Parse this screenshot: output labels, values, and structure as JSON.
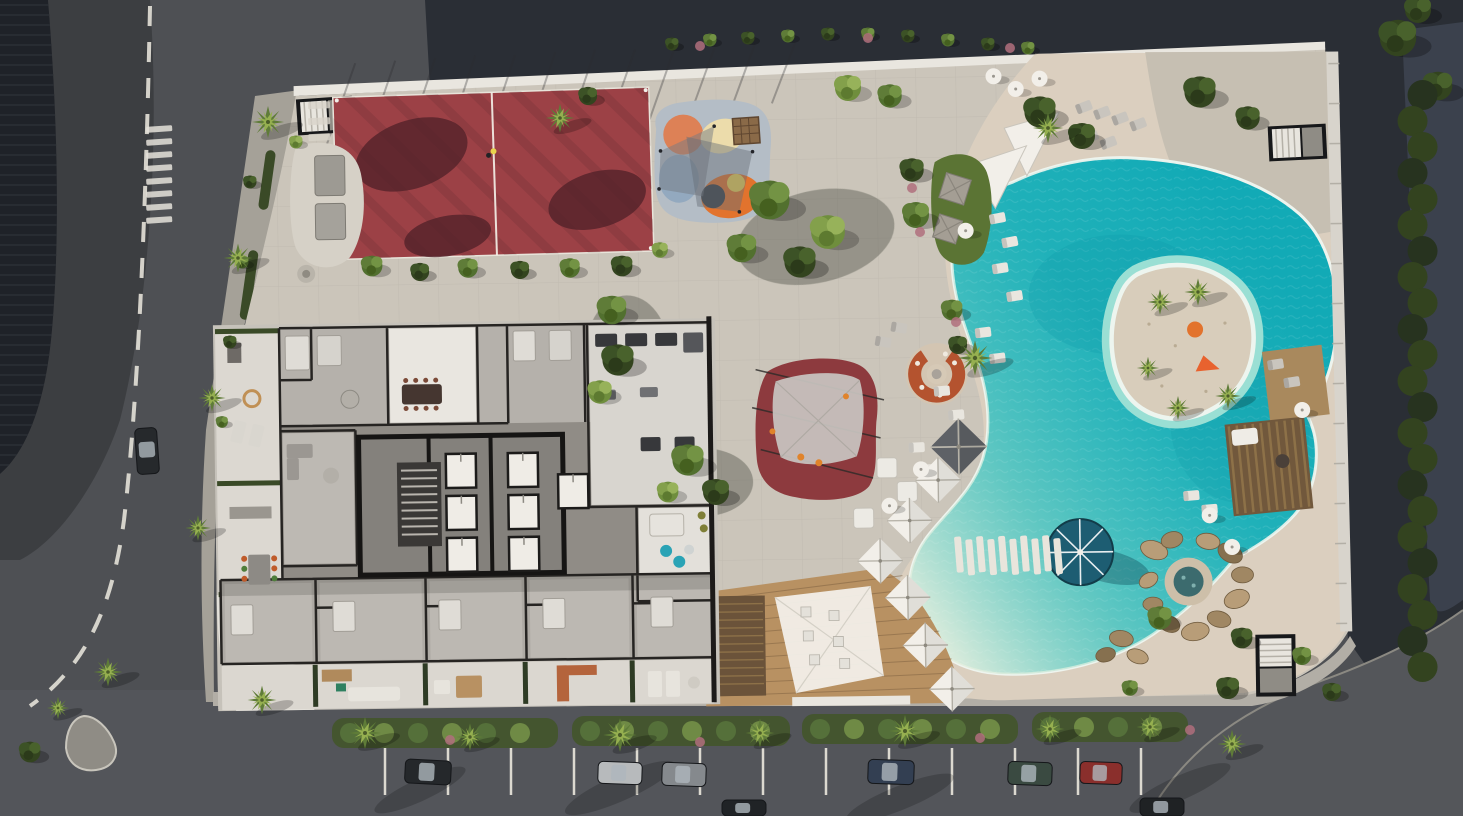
{
  "scene": {
    "type": "aerial-architectural-render",
    "description": "Aerial 3D rendering of a residential resort block: cutaway apartment floor plan, red sports court, playgrounds, gardens, lagoon-style pool with island, beach club deck, surrounding streets with parked cars and palm trees.",
    "areas": {
      "street_left": {
        "label": "Street with dashed lane line"
      },
      "street_bottom": {
        "label": "Street with parallel parking"
      },
      "roof_corner": {
        "label": "Adjacent building roof"
      },
      "site": {
        "label": "Resort podium deck"
      },
      "court": {
        "label": "Red multi-sport court"
      },
      "playground": {
        "label": "Colorful kids playground"
      },
      "canopy_playground": {
        "label": "Red play area with shade sail"
      },
      "firepit": {
        "label": "Sunken fire-pit lounge"
      },
      "gardens": {
        "label": "Landscaped garden paths"
      },
      "pool": {
        "label": "Lagoon swimming pool"
      },
      "island": {
        "label": "Pool island with palms"
      },
      "spa": {
        "label": "Rock grotto spa"
      },
      "deck": {
        "label": "Beach-club timber deck"
      },
      "building": {
        "label": "Apartment building floor plan"
      },
      "parking": {
        "label": "Street parking with cars"
      },
      "hedge_right": {
        "label": "Perimeter hedge"
      }
    },
    "palms": [
      [
        268,
        122,
        1.0
      ],
      [
        238,
        258,
        0.9
      ],
      [
        212,
        398,
        0.85
      ],
      [
        198,
        528,
        0.8
      ],
      [
        108,
        672,
        0.9
      ],
      [
        58,
        708,
        0.7
      ],
      [
        262,
        700,
        0.9
      ],
      [
        365,
        733,
        1.0
      ],
      [
        470,
        737,
        0.85
      ],
      [
        620,
        735,
        1.05
      ],
      [
        760,
        733,
        0.9
      ],
      [
        905,
        731,
        1.0
      ],
      [
        1050,
        729,
        0.9
      ],
      [
        1150,
        727,
        0.85
      ],
      [
        1232,
        744,
        0.9
      ],
      [
        975,
        358,
        1.1
      ],
      [
        1048,
        128,
        0.95
      ],
      [
        560,
        118,
        0.9
      ],
      [
        1160,
        302,
        0.8
      ],
      [
        1198,
        292,
        0.85
      ],
      [
        1228,
        396,
        0.8
      ],
      [
        1178,
        408,
        0.75
      ],
      [
        1148,
        368,
        0.7
      ]
    ],
    "trees": [
      [
        "m",
        770,
        200,
        1.5
      ],
      [
        "l",
        828,
        232,
        1.3
      ],
      [
        "d",
        800,
        262,
        1.2
      ],
      [
        "m",
        742,
        248,
        1.1
      ],
      [
        "m",
        612,
        310,
        1.1
      ],
      [
        "d",
        618,
        360,
        1.2
      ],
      [
        "l",
        600,
        392,
        0.9
      ],
      [
        "m",
        688,
        460,
        1.2
      ],
      [
        "d",
        716,
        492,
        1.0
      ],
      [
        "l",
        668,
        492,
        0.8
      ],
      [
        "d",
        912,
        170,
        0.9
      ],
      [
        "m",
        916,
        215,
        1.0
      ],
      [
        "m",
        952,
        310,
        0.8
      ],
      [
        "d",
        958,
        345,
        0.7
      ],
      [
        "l",
        848,
        88,
        1.0
      ],
      [
        "m",
        890,
        96,
        0.9
      ],
      [
        "d",
        1040,
        112,
        1.2
      ],
      [
        "d",
        1082,
        136,
        1.0
      ],
      [
        "d",
        1200,
        92,
        1.2
      ],
      [
        "d",
        1248,
        118,
        0.9
      ],
      [
        "d",
        1398,
        38,
        1.4
      ],
      [
        "d",
        1438,
        86,
        1.1
      ],
      [
        "d",
        1418,
        10,
        1.0
      ],
      [
        "m",
        1160,
        618,
        0.9
      ],
      [
        "d",
        1242,
        638,
        0.8
      ],
      [
        "m",
        1302,
        656,
        0.7
      ],
      [
        "d",
        1228,
        688,
        0.85
      ],
      [
        "m",
        1130,
        688,
        0.6
      ],
      [
        "d",
        1332,
        692,
        0.7
      ],
      [
        "m",
        372,
        266,
        0.8
      ],
      [
        "d",
        420,
        272,
        0.7
      ],
      [
        "m",
        468,
        268,
        0.75
      ],
      [
        "d",
        520,
        270,
        0.7
      ],
      [
        "m",
        570,
        268,
        0.75
      ],
      [
        "d",
        622,
        266,
        0.8
      ],
      [
        "l",
        660,
        250,
        0.6
      ],
      [
        "d",
        250,
        182,
        0.5
      ],
      [
        "m",
        242,
        262,
        0.5
      ],
      [
        "d",
        230,
        342,
        0.5
      ],
      [
        "m",
        222,
        422,
        0.45
      ],
      [
        "d",
        588,
        96,
        0.7
      ],
      [
        "l",
        296,
        142,
        0.5
      ],
      [
        "d",
        30,
        752,
        0.8
      ],
      [
        "d",
        672,
        44,
        0.5
      ],
      [
        "m",
        710,
        40,
        0.5
      ],
      [
        "d",
        748,
        38,
        0.5
      ],
      [
        "m",
        788,
        36,
        0.5
      ],
      [
        "d",
        828,
        34,
        0.5
      ],
      [
        "m",
        868,
        34,
        0.5
      ],
      [
        "d",
        908,
        36,
        0.5
      ],
      [
        "m",
        948,
        40,
        0.5
      ],
      [
        "d",
        988,
        44,
        0.5
      ],
      [
        "m",
        1028,
        48,
        0.5
      ]
    ],
    "pink_bushes": [
      [
        912,
        188
      ],
      [
        920,
        232
      ],
      [
        956,
        322
      ],
      [
        700,
        46
      ],
      [
        868,
        38
      ],
      [
        1010,
        48
      ],
      [
        450,
        740
      ],
      [
        700,
        742
      ],
      [
        980,
        738
      ],
      [
        1190,
        730
      ]
    ],
    "loungers": [
      [
        1000,
        222,
        -10,
        "w"
      ],
      [
        1012,
        246,
        -10,
        "w"
      ],
      [
        1002,
        272,
        -8,
        "w"
      ],
      [
        1016,
        300,
        -8,
        "w"
      ],
      [
        984,
        336,
        -6,
        "w"
      ],
      [
        998,
        362,
        -6,
        "w"
      ],
      [
        942,
        394,
        -4,
        "w"
      ],
      [
        956,
        418,
        -4,
        "w"
      ],
      [
        916,
        450,
        -2,
        "w"
      ],
      [
        930,
        472,
        -2,
        "w"
      ],
      [
        1088,
        112,
        -20,
        "g"
      ],
      [
        1106,
        118,
        -20,
        "g"
      ],
      [
        1124,
        124,
        -20,
        "g"
      ],
      [
        1142,
        130,
        -20,
        "g"
      ],
      [
        1094,
        142,
        -20,
        "g"
      ],
      [
        1112,
        148,
        -20,
        "g"
      ],
      [
        1276,
        372,
        -8,
        "g"
      ],
      [
        1292,
        390,
        -8,
        "g"
      ],
      [
        1190,
        502,
        -4,
        "w"
      ],
      [
        1208,
        516,
        -4,
        "w"
      ],
      [
        900,
        330,
        10,
        "g"
      ],
      [
        884,
        344,
        10,
        "g"
      ]
    ],
    "daybeds": [
      [
        886,
        470
      ],
      [
        906,
        494
      ],
      [
        862,
        520
      ]
    ],
    "sq_umbrellas_white": [
      [
        937,
        483
      ],
      [
        908,
        523
      ],
      [
        878,
        563
      ],
      [
        905,
        600
      ],
      [
        922,
        648
      ],
      [
        948,
        692
      ]
    ],
    "sq_umbrellas_dark": [
      [
        958,
        450
      ]
    ],
    "rnd_umbrellas": [
      [
        998,
        80
      ],
      [
        1020,
        93
      ],
      [
        1044,
        83
      ],
      [
        920,
        472
      ],
      [
        888,
        508
      ],
      [
        1208,
        522
      ],
      [
        1230,
        554
      ],
      [
        968,
        234
      ],
      [
        1302,
        418
      ]
    ],
    "cabanas": [
      [
        958,
        192,
        26
      ],
      [
        950,
        232,
        24
      ]
    ],
    "rocks": [
      [
        1152,
        556,
        14,
        9,
        20,
        "a"
      ],
      [
        1170,
        546,
        11,
        8,
        -15,
        "b"
      ],
      [
        1206,
        548,
        12,
        8,
        10,
        "a"
      ],
      [
        1228,
        560,
        13,
        9,
        30,
        "c"
      ],
      [
        1240,
        582,
        11,
        8,
        0,
        "b"
      ],
      [
        1234,
        606,
        13,
        9,
        -20,
        "a"
      ],
      [
        1216,
        626,
        12,
        8,
        15,
        "b"
      ],
      [
        1192,
        638,
        14,
        9,
        -10,
        "a"
      ],
      [
        1166,
        630,
        11,
        8,
        25,
        "c"
      ],
      [
        1150,
        610,
        10,
        7,
        0,
        "b"
      ],
      [
        1146,
        586,
        10,
        7,
        -30,
        "a"
      ],
      [
        1118,
        644,
        12,
        8,
        10,
        "b"
      ],
      [
        1102,
        660,
        10,
        7,
        -15,
        "c"
      ],
      [
        1134,
        662,
        11,
        7,
        20,
        "a"
      ]
    ],
    "cars_parked": [
      [
        405,
        760,
        46,
        24,
        3,
        "#25282b"
      ],
      [
        598,
        762,
        44,
        22,
        2,
        "#b7babc"
      ],
      [
        662,
        763,
        44,
        23,
        2,
        "#85898d"
      ],
      [
        868,
        760,
        46,
        24,
        2,
        "#333f52"
      ],
      [
        1008,
        762,
        44,
        23,
        2,
        "#3a4a41"
      ],
      [
        1080,
        762,
        42,
        22,
        2,
        "#8a2f2c"
      ],
      [
        722,
        800,
        44,
        16,
        0,
        "#202326"
      ],
      [
        1140,
        798,
        44,
        18,
        0,
        "#1f2224"
      ],
      [
        136,
        428,
        22,
        46,
        -4,
        "#26292c"
      ]
    ],
    "stall_lines_x": [
      385,
      448,
      511,
      574,
      637,
      700,
      763,
      826,
      889,
      952,
      1015,
      1078,
      1141
    ],
    "median_segments": [
      [
        332,
        718,
        226
      ],
      [
        572,
        716,
        218
      ],
      [
        802,
        714,
        216
      ],
      [
        1032,
        712,
        156
      ]
    ],
    "elevators": [
      [
        445,
        450
      ],
      [
        445,
        492
      ],
      [
        445,
        534
      ],
      [
        507,
        450
      ],
      [
        507,
        492
      ],
      [
        507,
        534
      ],
      [
        557,
        472
      ]
    ],
    "ladder_bars": {
      "x": 146,
      "y": 126,
      "w": 26,
      "h": 6,
      "n": 8,
      "dy": 13
    },
    "stepping_stones": {
      "x": 312,
      "y": 96,
      "w": 22,
      "h": 7,
      "n": 10,
      "dy": 16
    },
    "walk_ticks": {
      "x": 1333,
      "y": 72,
      "n": 15,
      "dy": 40
    },
    "bridge_slats": {
      "x": 952,
      "y": 540,
      "n": 10,
      "dx": 11,
      "w": 7,
      "h": 36
    }
  },
  "colors": {
    "asphalt": "#4e5054",
    "asphalt_dark": "#2a2e35",
    "roof_dark": "#1f2228",
    "sidewalk": "#a5a198",
    "island_paved": "#8f8c85",
    "slab": "#cbc5ba",
    "sand": "#dbcfbf",
    "parapet": "#e9e6df",
    "court_red": "#9c4146",
    "court_shadow": "#54222a",
    "playground_base": "#b4bdc6",
    "playground_orange": "#e2732d",
    "playground_salmon": "#dd8156",
    "playground_cream": "#ecdcab",
    "playground_blue": "#93a9bf",
    "playground_yellow": "#ecd052",
    "canopy_red": "#8d3a3e",
    "sail_gray": "#c9c6c1",
    "fire_ring": "#b4532f",
    "pool_deep": "#12aab6",
    "pool_rim": "#eef4ee",
    "island_sand": "#d8cdbb",
    "navy_umbrella": "#1d5d72",
    "wood": "#b89162",
    "pergola": "#71583c",
    "stone_wall": "#6b533a",
    "hedge": "#2e3b24",
    "tree_dark": "#3c5226",
    "tree_mid": "#5f7c38",
    "tree_light": "#83a04b",
    "pink": "#b06f7c",
    "white": "#f2efe9",
    "lounger": "#e9e6df",
    "lounger_gray": "#c9c5be",
    "cabana": "#a49e94",
    "terrace": "#dcd8d1",
    "floor": "#b5b1ab",
    "floor_light": "#d8d5cf",
    "room_white": "#e9e6e0",
    "corridor": "#908c86",
    "wall": "#262422",
    "teal_pouf": "#2aa3b5",
    "terracotta": "#b4643c",
    "blue_pavement": "#3d4450"
  }
}
